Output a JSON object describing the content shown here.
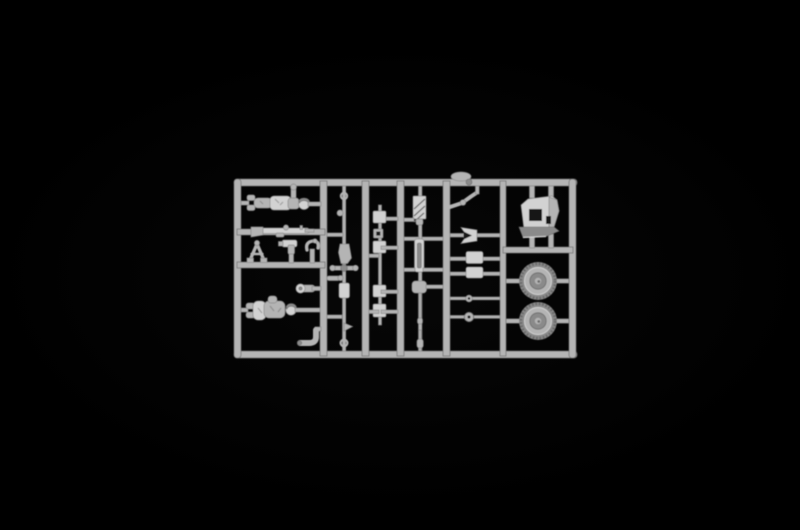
{
  "scene": {
    "description": "Photograph of a light gray injection-molded plastic model kit sprue centered on a black background",
    "object": "model-kit-sprue",
    "content_type": "photo"
  },
  "colors": {
    "background": "#000000",
    "vignette": "#070707",
    "plastic_mid": "#b4b4b4",
    "plastic_light": "#d2d2d2",
    "plastic_dark": "#8a8a8a",
    "plastic_deep": "#6a6a6a",
    "hole": "#141414"
  },
  "sprue": {
    "frame": {
      "x": 234,
      "y": 179,
      "width": 343,
      "height": 179,
      "rail_thickness": 7
    },
    "counts": {
      "figures": 2,
      "wheels": 2,
      "small_box_parts": 4,
      "vertical_rails": 7
    },
    "wheels": [
      {
        "cx": 538,
        "cy": 281,
        "r": 19
      },
      {
        "cx": 538,
        "cy": 321,
        "r": 19
      }
    ],
    "parts": [
      {
        "name": "standing-figure",
        "location": "top-left cell",
        "description": "soldier figure lying horizontally, arm raised to top rail"
      },
      {
        "name": "rifle",
        "location": "left, on first mid rail",
        "description": "rifle molded along horizontal rail"
      },
      {
        "name": "bipod-frame",
        "location": "left, second row",
        "description": "A-shaped bipod/tripod frame"
      },
      {
        "name": "pistol-grip-part",
        "location": "left, second row",
        "description": "small L-shaped grip part"
      },
      {
        "name": "hooked-lever",
        "location": "left, second row",
        "description": "small curved hook part"
      },
      {
        "name": "crouching-figure",
        "location": "bottom-left cell",
        "description": "second soldier figure lying horizontally"
      },
      {
        "name": "pipe-elbow-upper",
        "location": "bottom-left cell",
        "description": "elbow pipe with round cap"
      },
      {
        "name": "pipe-elbow-lower",
        "location": "bottom-left cell",
        "description": "L-bend pipe part"
      },
      {
        "name": "gun-barrel-assembly",
        "location": "second column, full height",
        "description": "long vertical gun barrel with rings, knob, cradle and cross piece"
      },
      {
        "name": "small-box-parts",
        "location": "third column",
        "description": "four small box parts plus hollow square on thin runner"
      },
      {
        "name": "hatched-slide",
        "location": "fourth column top",
        "description": "rectangular part with diagonal hatching"
      },
      {
        "name": "cylinder-part",
        "location": "fourth column middle",
        "description": "thick vertical cylinder"
      },
      {
        "name": "linkage-with-rod",
        "location": "fourth column bottom",
        "description": "lumpy linkage with long thin rod"
      },
      {
        "name": "bent-crank-rod",
        "location": "fifth column top",
        "description": "angled crank rod with knob"
      },
      {
        "name": "funnel-bracket",
        "location": "fifth column",
        "description": "trapezoid bracket open to the left on rod"
      },
      {
        "name": "box-on-rod-1",
        "location": "fifth column",
        "description": "rectangular block on horizontal rod"
      },
      {
        "name": "box-on-rod-2",
        "location": "fifth column",
        "description": "rectangular block on horizontal rod"
      },
      {
        "name": "ring-rod-small",
        "location": "fifth column",
        "description": "thin rod with small ring"
      },
      {
        "name": "ring-rod-gear",
        "location": "fifth column",
        "description": "thin rod with serrated disc"
      },
      {
        "name": "gun-shield",
        "location": "right column top",
        "description": "angular gun shield plate with cut-out notch and folded lower flap"
      },
      {
        "name": "road-wheel-upper",
        "location": "right column",
        "description": "treaded road wheel on axle rod"
      },
      {
        "name": "road-wheel-lower",
        "location": "right column",
        "description": "treaded road wheel on axle rod"
      },
      {
        "name": "sprue-gate-blob",
        "location": "on top rail",
        "description": "flattened sprue gate lump"
      }
    ]
  }
}
